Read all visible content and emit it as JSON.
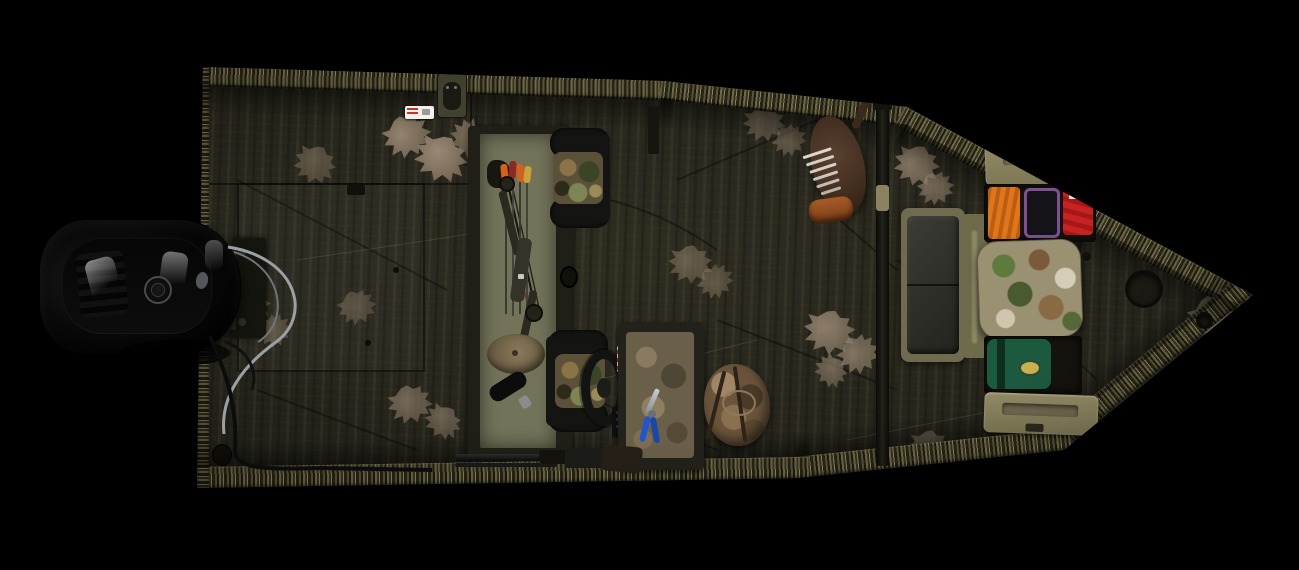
{
  "scene": {
    "type": "product-photo",
    "subject": "Overhead view of a camouflage hunting jon boat with outboard motor and hunting gear",
    "background_color": "#000000",
    "camo_style": "dark bottomland camo with pale oak-leaf prints and grass-pattern gunwales"
  },
  "palette": {
    "background": "#000000",
    "hull_base": "#26251c",
    "gunwale_olive": "#6e6847",
    "compartment_interior_olive": "#73735a",
    "lid_tan": "#8a8260",
    "bench_vinyl": "#33332d",
    "motor_black": "#0a0a0b",
    "cable_gray": "#9aa0a4",
    "vest_orange": "#e0761c",
    "bag_red": "#c92222",
    "cooler_trim_purple": "#7d5190",
    "gear_bag_green": "#1c5a40",
    "logo_patch_yellow": "#c8b050",
    "leaf_print_tan": "#a5937e",
    "turkey_body_brown": "#4a3526",
    "turkey_base_orange": "#a85c28",
    "pliers_blue": "#2255cc"
  },
  "objects": [
    {
      "name": "outboard-motor",
      "color": "#0a0a0b",
      "position": "stern, left side"
    },
    {
      "name": "motor-bracket",
      "color": "#15150f"
    },
    {
      "name": "rigging-cables",
      "color": "#9aa0a4"
    },
    {
      "name": "stern-deck-hatch",
      "color": "#26251c"
    },
    {
      "name": "capacity-sticker",
      "color": "#ffffff"
    },
    {
      "name": "gunwale-fitting",
      "color": "#42402f"
    },
    {
      "name": "bow-storage-compartment",
      "color": "#73735a"
    },
    {
      "name": "compound-bow",
      "color": "#2a2a20"
    },
    {
      "name": "arrows-with-fletching",
      "color": "#d4601c"
    },
    {
      "name": "camo-cap",
      "color": "#8a7a5c"
    },
    {
      "name": "black-bottle",
      "color": "#0c0c0c"
    },
    {
      "name": "front-pedestal-seat",
      "color": "#5a5138"
    },
    {
      "name": "rear-pedestal-seat",
      "color": "#5a5138"
    },
    {
      "name": "steering-wheel",
      "color": "#141412"
    },
    {
      "name": "throttle-control",
      "color": "#101010"
    },
    {
      "name": "center-console-box",
      "color": "#6a604a"
    },
    {
      "name": "pliers",
      "color": "#2255cc"
    },
    {
      "name": "shotgun",
      "color": "#1a1a18"
    },
    {
      "name": "hunting-backpack",
      "color": "#6b543c"
    },
    {
      "name": "turkey-decoy",
      "color": "#4a3526"
    },
    {
      "name": "vertical-rail",
      "color": "#15130e"
    },
    {
      "name": "bench-seat",
      "color": "#33332d"
    },
    {
      "name": "storage-lid-top",
      "color": "#8a8260"
    },
    {
      "name": "gear-compartment-top",
      "color": "#14130e"
    },
    {
      "name": "orange-safety-vest",
      "color": "#e0761c"
    },
    {
      "name": "soft-cooler-purple-trim",
      "color": "#7d5190"
    },
    {
      "name": "red-gear-bag",
      "color": "#c92222"
    },
    {
      "name": "camo-seat-cushion",
      "color": "#9a9072"
    },
    {
      "name": "green-gear-bag",
      "color": "#1c5a40"
    },
    {
      "name": "storage-lid-bottom",
      "color": "#8a8260"
    },
    {
      "name": "round-deck-hatch",
      "color": "#1b1a13"
    },
    {
      "name": "drain-plug",
      "color": "#12110b"
    }
  ]
}
